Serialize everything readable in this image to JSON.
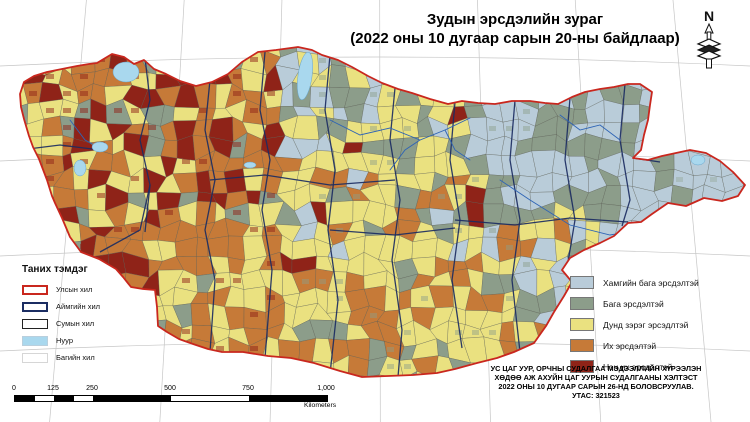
{
  "title": {
    "line1": "Зудын эрсдэлийн зураг",
    "line2": "(2022 оны 10 дугаар сарын 20-ны байдлаар)"
  },
  "north_arrow": {
    "label": "N"
  },
  "legend_left": {
    "header": "Таних тэмдэг",
    "items": [
      {
        "label": "Улсын хил",
        "type": "outline",
        "stroke": "#c9271e",
        "stroke_w": 2,
        "fill": "#ffffff"
      },
      {
        "label": "Аймгийн хил",
        "type": "outline",
        "stroke": "#1b2d62",
        "stroke_w": 2,
        "fill": "#ffffff"
      },
      {
        "label": "Сумын хил",
        "type": "outline",
        "stroke": "#222222",
        "stroke_w": 1.5,
        "fill": "#ffffff"
      },
      {
        "label": "Нуур",
        "type": "fill",
        "stroke": "#b9cfdd",
        "stroke_w": 0.5,
        "fill": "#a9d8ee"
      },
      {
        "label": "Багийн хил",
        "type": "outline",
        "stroke": "#d6d6d6",
        "stroke_w": 1,
        "fill": "#ffffff"
      }
    ]
  },
  "legend_right": {
    "items": [
      {
        "label": "Хамгийн бага эрсдэлтэй",
        "color": "#b9ccd9"
      },
      {
        "label": "Бага эрсдэлтэй",
        "color": "#8c9d8a"
      },
      {
        "label": "Дунд зэрэг эрсэдлтэй",
        "color": "#eae180"
      },
      {
        "label": "Их эрсдэлтэй",
        "color": "#c67a38"
      },
      {
        "label": "Нэн их эрсдэлтэй",
        "color": "#8f2318"
      }
    ]
  },
  "attribution": {
    "lines": [
      "УС ЦАГ УУР, ОРЧНЫ СУДАЛГАА МЭДЭЭЛЛИЙН ХҮРЭЭЛЭН",
      "ХӨДӨӨ АЖ АХУЙН ЦАГ УУРЫН СУДАЛГААНЫ ХЭЛТЭСТ",
      "2022 ОНЫ 10 ДУГААР САРЫН 26-НД БОЛОВСРУУЛАВ.",
      "УТАС: 321523"
    ]
  },
  "scalebar": {
    "ticks": [
      "0",
      "125",
      "250",
      "500",
      "750",
      "1,000"
    ],
    "tick_km": [
      0,
      125,
      250,
      500,
      750,
      1000
    ],
    "unit": "Kilometers"
  },
  "map": {
    "risk_colors": {
      "lowest": "#b9ccd9",
      "low": "#8c9d8a",
      "medium": "#eae180",
      "high": "#c67a38",
      "highest": "#8f2318"
    },
    "lake_color": "#a9d8ee",
    "river_color": "#2e64b5",
    "country_border_color": "#c9271e",
    "aimag_border_color": "#1b2d62",
    "soum_border_color": "#565a50",
    "graticule_color": "#c6c6c6"
  }
}
